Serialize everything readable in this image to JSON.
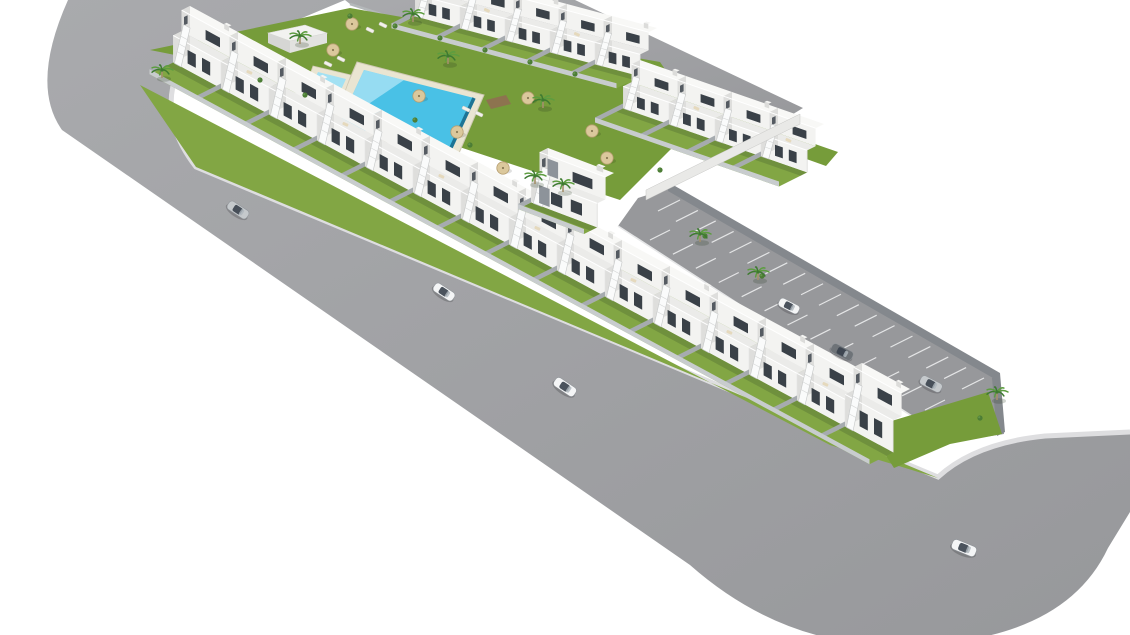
{
  "scene": {
    "description": "Aerial 3D architectural rendering of a modern white townhouse residential development with communal lawn, swimming pool, private gardens, parking strip and surrounding curved streets",
    "background_color": "#ffffff",
    "colors": {
      "road": "#97989b",
      "road_light": "#a9aaad",
      "curb": "#dedee0",
      "wall_dark": "#84888d",
      "grass": "#82a644",
      "grass_dark": "#769c3a",
      "shadow": "rgba(45,70,35,0.22)",
      "wall_side": "#a6abaf",
      "wall_front": "#c8ccce",
      "house_front": "#f3f3f1",
      "house_side": "#dededc",
      "house_roof": "#ebebe9",
      "house_roof_top": "#f8f8f6",
      "window": "#3a4148",
      "window_side": "#555b62",
      "stair": "#fafbfb",
      "pool_deck": "#eae5d2",
      "pool_water": "#49c1e6",
      "pool_shallow": "#a3e1f3",
      "pool_deep": "#1d7495",
      "wood": "#8d734f",
      "palm_dark": "#3e7a31",
      "palm_light": "#5d9d40",
      "trunk": "#a4906c",
      "umbrella": "#dbc89c",
      "umbrella_rim": "#b59d6f",
      "car_silver": "#c5c9cc",
      "car_white": "#f4f5f6",
      "car_dark": "#6e7378",
      "cabin": "#39414d",
      "accent": "#8d939a"
    }
  },
  "roads": {
    "main": {
      "d": "M68,0 Q30,85 62,130 L690,565 Q775,640 880,645 Q1060,650 1108,548 L1130,512 L1130,432 L1045,436 Q972,442 938,477 L196,167 Q158,118 178,70 L345,0 Z"
    },
    "top": {
      "d": "M345,0 L575,0 L803,108 L757,136 L350,4 Z"
    },
    "parking": {
      "outline": [
        [
          638,
          198
        ],
        [
          672,
          187
        ],
        [
          1000,
          380
        ],
        [
          1004,
          434
        ],
        [
          952,
          442
        ],
        [
          618,
          226
        ]
      ],
      "back_wall": [
        [
          668,
          182
        ],
        [
          1000,
          373
        ],
        [
          1000,
          382
        ],
        [
          668,
          191
        ]
      ],
      "end_wall": [
        [
          1000,
          373
        ],
        [
          1005,
          432
        ],
        [
          997,
          436
        ],
        [
          992,
          378
        ]
      ]
    },
    "curbs": {
      "main": "M178,70 Q158,118 196,167 L938,477 Q975,443 1045,436 L1130,432",
      "top_wall": "M350,4 L757,136",
      "parking_front": "M618,226 L952,442"
    },
    "markings": {
      "back_row": {
        "from": [
          680,
          200
        ],
        "to": [
          984,
          378
        ],
        "count": 18,
        "dir": [
          -22,
          11
        ]
      },
      "front_row": {
        "from": [
          650,
          240
        ],
        "to": [
          925,
          410
        ],
        "count": 13,
        "dir": [
          20,
          -10
        ]
      }
    },
    "entrance_wall": [
      [
        800,
        114
      ],
      [
        646,
        190
      ],
      [
        646,
        200
      ],
      [
        800,
        124
      ]
    ]
  },
  "greens": {
    "polys": [
      {
        "name": "street-verge",
        "points": [
          [
            140,
            85
          ],
          [
            830,
            445
          ],
          [
            938,
            478
          ],
          [
            196,
            167
          ]
        ]
      },
      {
        "name": "communal-lawn",
        "points": [
          [
            150,
            50
          ],
          [
            350,
            8
          ],
          [
            660,
            62
          ],
          [
            700,
            120
          ],
          [
            620,
            200
          ],
          [
            190,
            58
          ]
        ]
      },
      {
        "name": "row-a-left-back-garden",
        "points": [
          [
            430,
            6
          ],
          [
            664,
            98
          ],
          [
            674,
            86
          ],
          [
            442,
            -6
          ]
        ]
      },
      {
        "name": "row-a-right-back-garden",
        "points": [
          [
            636,
            98
          ],
          [
            826,
            166
          ],
          [
            838,
            152
          ],
          [
            648,
            86
          ]
        ]
      },
      {
        "name": "row-b-back-garden",
        "points": [
          [
            600,
            280
          ],
          [
            895,
            450
          ],
          [
            912,
            432
          ],
          [
            617,
            262
          ]
        ]
      },
      {
        "name": "right-end-garden",
        "points": [
          [
            868,
            428
          ],
          [
            988,
            392
          ],
          [
            1002,
            434
          ],
          [
            950,
            444
          ],
          [
            894,
            468
          ]
        ]
      }
    ]
  },
  "house_rows": [
    {
      "name": "row-a-left",
      "origin": [
        432,
        8
      ],
      "unit": [
        45,
        12
      ],
      "front": [
        -30,
        15
      ],
      "count": 5,
      "h1": 22,
      "h2": 18,
      "garden": 1.35
    },
    {
      "name": "row-a-right",
      "origin": [
        640,
        100
      ],
      "unit": [
        46,
        16
      ],
      "front": [
        -30,
        15
      ],
      "count": 4,
      "h1": 22,
      "h2": 18,
      "garden": 1.5
    },
    {
      "name": "row-b",
      "origin": [
        190,
        54
      ],
      "unit": [
        48,
        26
      ],
      "front": [
        -30,
        15
      ],
      "count": 15,
      "h1": 27,
      "h2": 21,
      "garden": 1.35
    }
  ],
  "central_building": {
    "origin": [
      548,
      194
    ],
    "unit": [
      66,
      25
    ],
    "front": [
      -30,
      15
    ],
    "h1": 24,
    "h2": 22
  },
  "pool": {
    "deck": [
      [
        357,
        62
      ],
      [
        484,
        95
      ],
      [
        456,
        160
      ],
      [
        329,
        127
      ]
    ],
    "water": [
      [
        364,
        70
      ],
      [
        474,
        98
      ],
      [
        449,
        152
      ],
      [
        339,
        124
      ]
    ],
    "shallow": [
      [
        364,
        70
      ],
      [
        404,
        80
      ],
      [
        339,
        124
      ]
    ],
    "deep_edge": [
      [
        474,
        98
      ],
      [
        449,
        152
      ]
    ],
    "kids_deck": [
      [
        313,
        66
      ],
      [
        351,
        75
      ],
      [
        343,
        97
      ],
      [
        305,
        88
      ]
    ],
    "kids_water": [
      [
        318,
        72
      ],
      [
        346,
        79
      ],
      [
        340,
        92
      ],
      [
        312,
        85
      ]
    ],
    "wood_decks": [
      [
        [
          344,
          152
        ],
        [
          372,
          146
        ],
        [
          378,
          158
        ],
        [
          350,
          164
        ]
      ],
      [
        [
          486,
          100
        ],
        [
          506,
          95
        ],
        [
          511,
          104
        ],
        [
          491,
          109
        ]
      ]
    ]
  },
  "shed": {
    "roof": [
      [
        268,
        33
      ],
      [
        305,
        25
      ],
      [
        327,
        33
      ],
      [
        290,
        41
      ]
    ],
    "front": [
      [
        290,
        41
      ],
      [
        327,
        33
      ],
      [
        327,
        43
      ],
      [
        290,
        53
      ]
    ],
    "side": [
      [
        268,
        33
      ],
      [
        290,
        41
      ],
      [
        290,
        53
      ],
      [
        268,
        43
      ]
    ]
  },
  "umbrellas": [
    [
      333,
      50
    ],
    [
      352,
      24
    ],
    [
      419,
      96
    ],
    [
      457,
      132
    ],
    [
      503,
      168
    ],
    [
      528,
      98
    ],
    [
      592,
      131
    ],
    [
      607,
      158
    ]
  ],
  "loungers": [
    [
      328,
      64
    ],
    [
      341,
      59
    ],
    [
      370,
      30
    ],
    [
      383,
      25
    ],
    [
      466,
      109
    ],
    [
      479,
      114
    ]
  ],
  "palms": [
    [
      162,
      76
    ],
    [
      300,
      42
    ],
    [
      413,
      20
    ],
    [
      448,
      62
    ],
    [
      543,
      106
    ],
    [
      535,
      182
    ],
    [
      563,
      190
    ],
    [
      700,
      240
    ],
    [
      758,
      278
    ],
    [
      997,
      398
    ]
  ],
  "bushes": [
    [
      350,
      16
    ],
    [
      395,
      26
    ],
    [
      440,
      38
    ],
    [
      485,
      50
    ],
    [
      530,
      62
    ],
    [
      575,
      74
    ],
    [
      260,
      80
    ],
    [
      305,
      95
    ],
    [
      660,
      170
    ],
    [
      705,
      236
    ],
    [
      762,
      276
    ],
    [
      980,
      418
    ],
    [
      415,
      120
    ],
    [
      470,
      145
    ]
  ],
  "cars": [
    {
      "x": 238,
      "y": 210,
      "angle": 33,
      "color": "car_silver",
      "scale": 1
    },
    {
      "x": 444,
      "y": 292,
      "angle": 33,
      "color": "car_white",
      "scale": 1
    },
    {
      "x": 565,
      "y": 387,
      "angle": 34,
      "color": "car_white",
      "scale": 1.05
    },
    {
      "x": 789,
      "y": 306,
      "angle": 27,
      "color": "car_white",
      "scale": 0.95
    },
    {
      "x": 842,
      "y": 352,
      "angle": 27,
      "color": "car_dark",
      "scale": 1
    },
    {
      "x": 931,
      "y": 384,
      "angle": 27,
      "color": "car_silver",
      "scale": 1
    },
    {
      "x": 964,
      "y": 548,
      "angle": 22,
      "color": "car_white",
      "scale": 1.1
    }
  ]
}
